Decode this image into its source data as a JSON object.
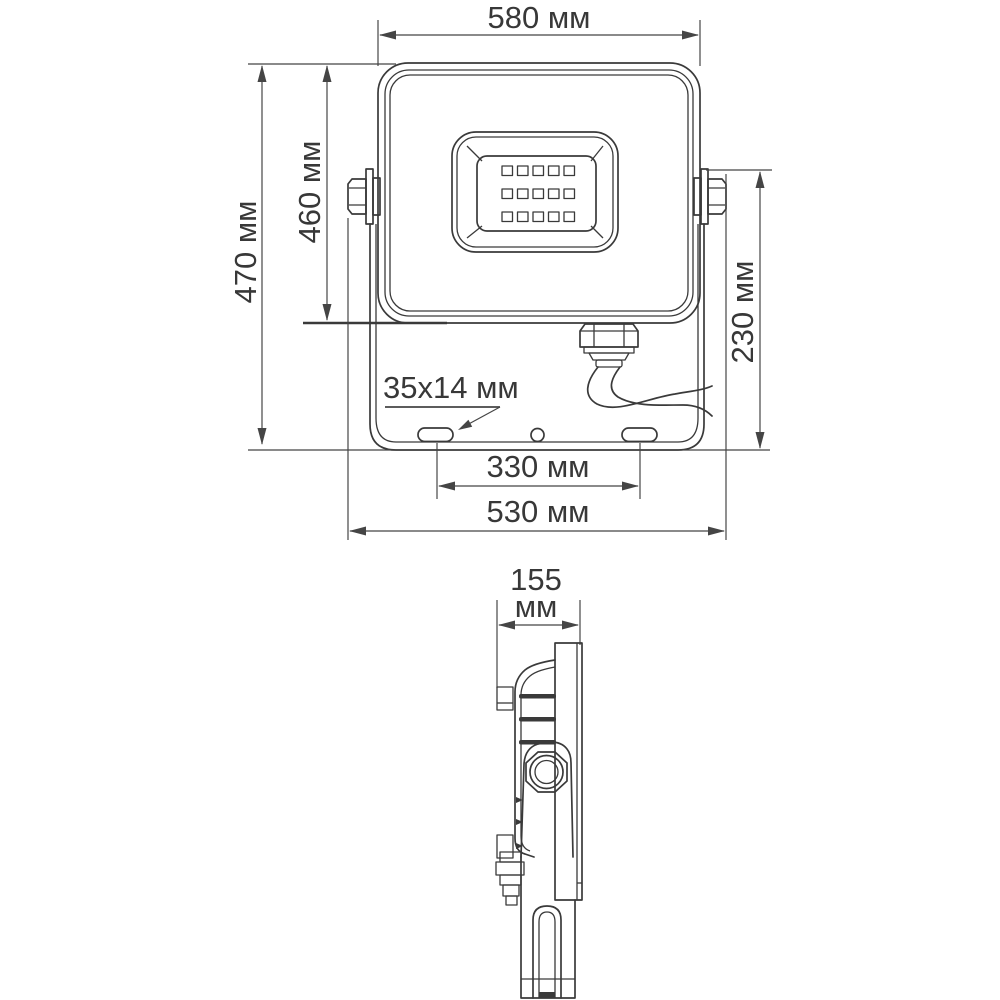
{
  "drawing": {
    "type": "technical dimensional drawing of LED floodlight",
    "units_label": "мм",
    "front_view": {
      "dim_width_top": "580 мм",
      "dim_height_overall": "470 мм",
      "dim_height_body": "460 мм",
      "dim_bracket_height": "230 мм",
      "slot_label": "35x14 мм",
      "dim_slot_spacing": "330 мм",
      "dim_width_bottom": "530 мм"
    },
    "side_view": {
      "dim_depth_value": "155",
      "dim_depth_unit": "мм"
    },
    "colors": {
      "line": "#3a3a3a",
      "dimension_line": "#454545",
      "text": "#383838",
      "background": "#ffffff"
    }
  }
}
